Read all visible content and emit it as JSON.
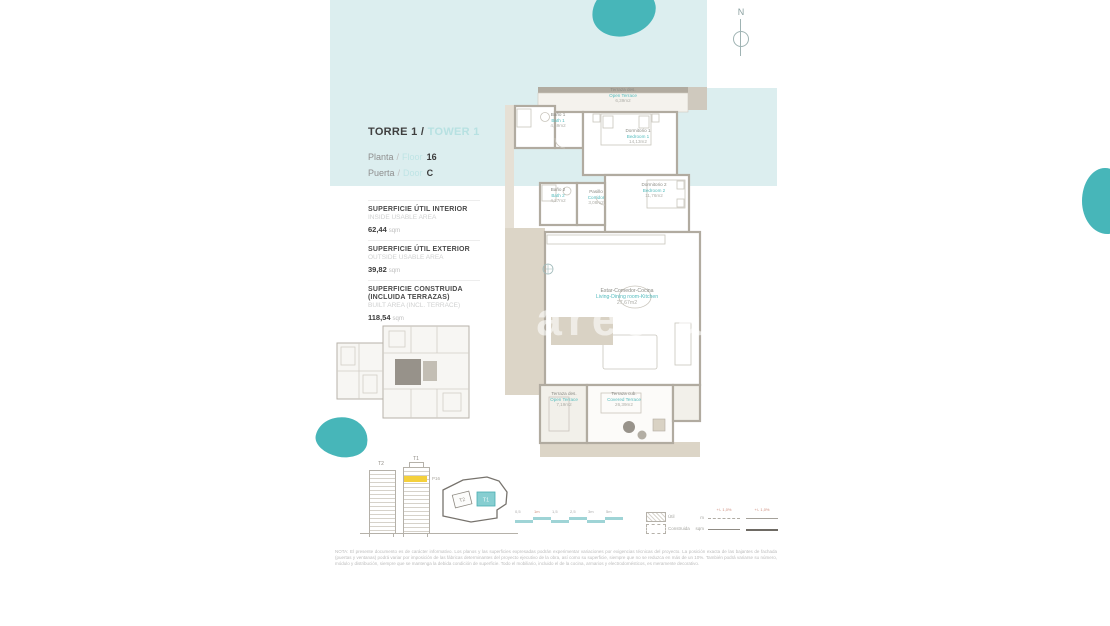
{
  "header": {
    "torre": "TORRE 1 /",
    "tower": "TOWER 1",
    "planta_label": "Planta",
    "floor_label": "Floor",
    "floor_value": "16",
    "puerta_label": "Puerta",
    "door_label": "Door",
    "door_value": "C",
    "slash": "/"
  },
  "compass": {
    "north": "N"
  },
  "areas": {
    "items": [
      {
        "es": "SUPERFICIE ÚTIL INTERIOR",
        "en": "INSIDE USABLE AREA",
        "value": "62,44",
        "unit": "sqm"
      },
      {
        "es": "SUPERFICIE ÚTIL EXTERIOR",
        "en": "OUTSIDE USABLE AREA",
        "value": "39,82",
        "unit": "sqm"
      },
      {
        "es": "SUPERFICIE CONSTRUIDA (INCLUIDA TERRAZAS)",
        "en": "BUILT AREA (INCL. TERRACE)",
        "value": "118,54",
        "unit": "sqm"
      }
    ]
  },
  "plan": {
    "watermark": "aresta",
    "rooms": [
      {
        "es": "Terraza des.",
        "en": "Open Terrace",
        "area": "6,39m2"
      },
      {
        "es": "Baño 1",
        "en": "Bath 1",
        "area": "4,69m2"
      },
      {
        "es": "Dormitorio 1",
        "en": "Bedroom 1",
        "area": "14,13m2"
      },
      {
        "es": "Dormitorio 2",
        "en": "Bedroom 2",
        "area": "11,76m2"
      },
      {
        "es": "Baño 2",
        "en": "Bath 2",
        "area": "4,27m2"
      },
      {
        "es": "Pasillo",
        "en": "Corridor",
        "area": "3,08m2"
      },
      {
        "es": "Estar-Comedor-Cocina",
        "en": "Living-Dining room-Kitchen",
        "area": "27,67m2"
      },
      {
        "es": "Terraza des.",
        "en": "Open Terrace",
        "area": "7,19m2"
      },
      {
        "es": "Terraza cub.",
        "en": "Covered Terrace",
        "area": "26,39m2"
      }
    ]
  },
  "elevations": {
    "t2": "T2",
    "t1": "T1",
    "floor_tag": "P16"
  },
  "siteplan": {
    "t2": "T2",
    "t1": "T1"
  },
  "scalebar": {
    "ticks": [
      "0,5",
      "1m",
      "1,5",
      "2,5",
      "3m",
      "5m"
    ]
  },
  "legend": {
    "items": [
      {
        "label": "Útil"
      },
      {
        "label": "Construida"
      }
    ],
    "row_labels": [
      "m",
      "sqm"
    ],
    "tables": [
      {
        "header": "+/- 1,0%"
      },
      {
        "header": "+/- 1,0%"
      }
    ]
  },
  "disclaimer": {
    "text": "NOTA: El presente documento es de carácter informativo. Los planos y las superficies expresadas podrán experimentar variaciones por exigencias técnicas del proyecto. La posición exacta de las bajantes de fachada (puertas y ventanas) podrá variar por imposición de las fábricas determinantes del proyecto ejecutivo de la obra, así como su superficie, siempre que no se reduzca en más de un 10%. También podrá variarse su número, módulo y distribución, siempre que se mantenga la debida condición de superficie. Todo el mobiliario, incluido el de la cocina, armarios y electrodomésticos, es meramente decorativo."
  }
}
